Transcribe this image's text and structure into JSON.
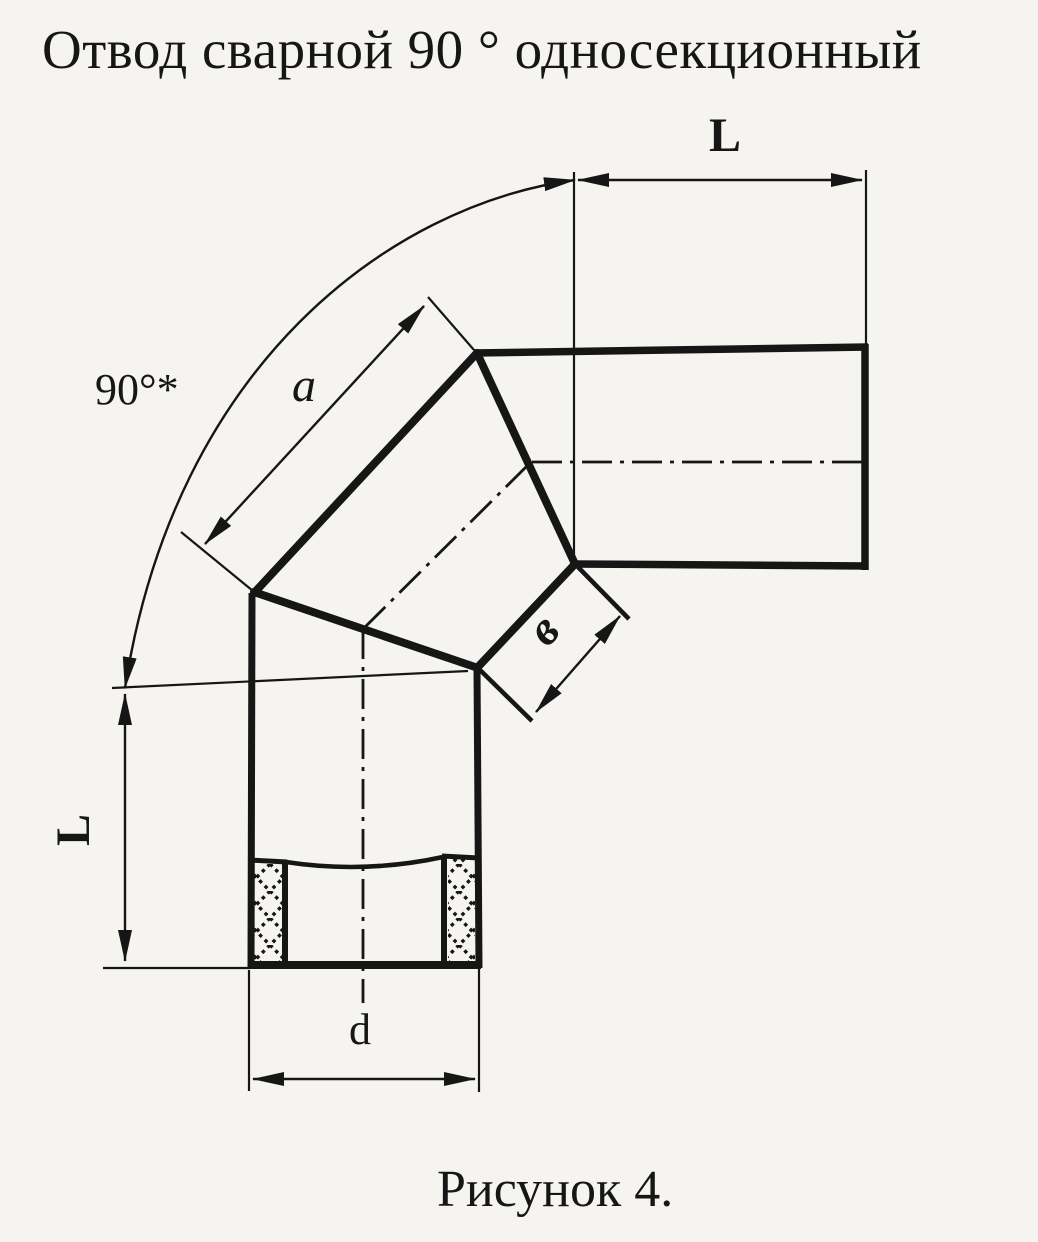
{
  "page": {
    "title": "Отвод сварной 90 ° односекционный",
    "caption": "Рисунок 4."
  },
  "drawing": {
    "figure_type": "technical-drawing",
    "dimension_labels": {
      "angle": "90°*",
      "top_length": "L",
      "left_length": "L",
      "section_long_edge": "a",
      "section_short_edge": "в",
      "diameter": "d"
    }
  }
}
